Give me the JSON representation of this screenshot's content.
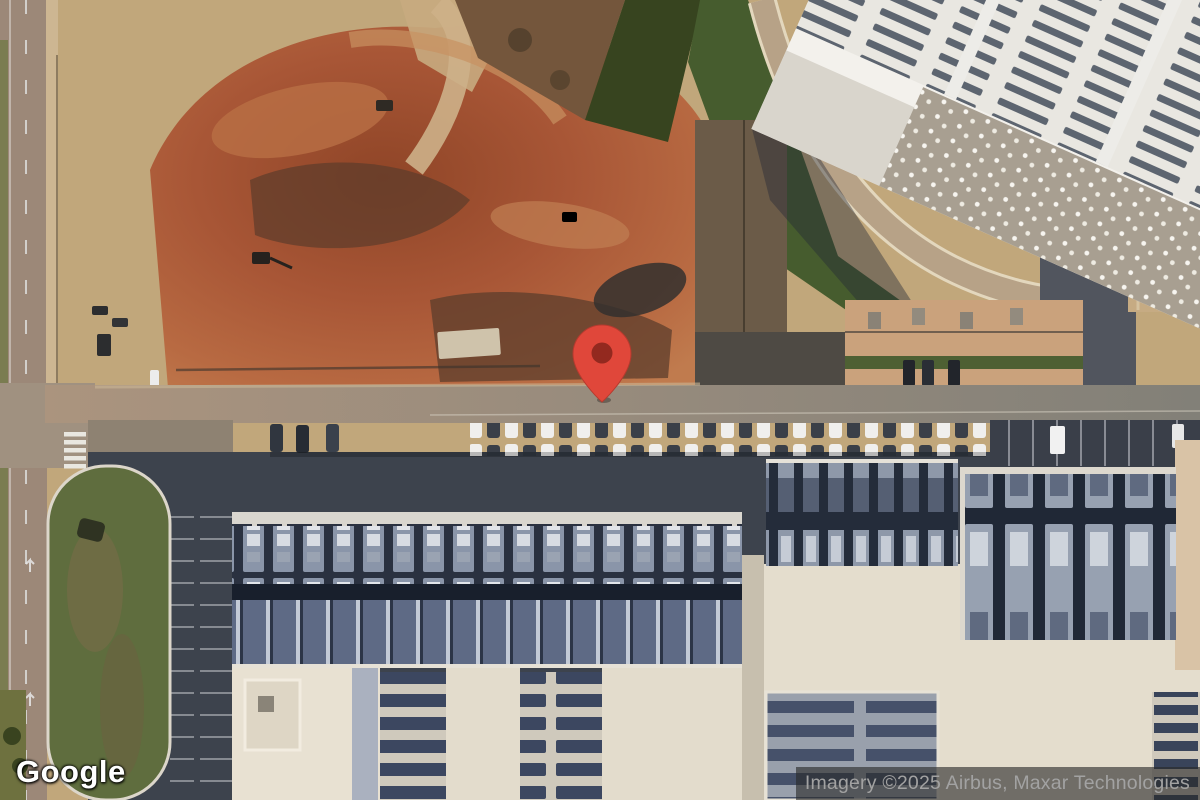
{
  "map": {
    "view_type": "satellite",
    "logo_text": "Google",
    "attribution_text": "Imagery ©2025 Airbus, Maxar Technologies",
    "marker": {
      "kind": "red-map-pin",
      "fill": "#E0473A",
      "dot_color": "#93291F",
      "tip_position_px": {
        "x": 602,
        "y": 401
      }
    },
    "palette": {
      "field_tan": "#c1a77b",
      "dirt_red": "#a85a3a",
      "asphalt_dark": "#3d434d",
      "roof_white": "#e9e7e1",
      "roof_cream": "#e3dccc",
      "hall_dark": "#242c3a",
      "lawn_green": "#445930",
      "attribution_bg": "#282828",
      "attribution_fg": "#a2a2a2"
    }
  }
}
